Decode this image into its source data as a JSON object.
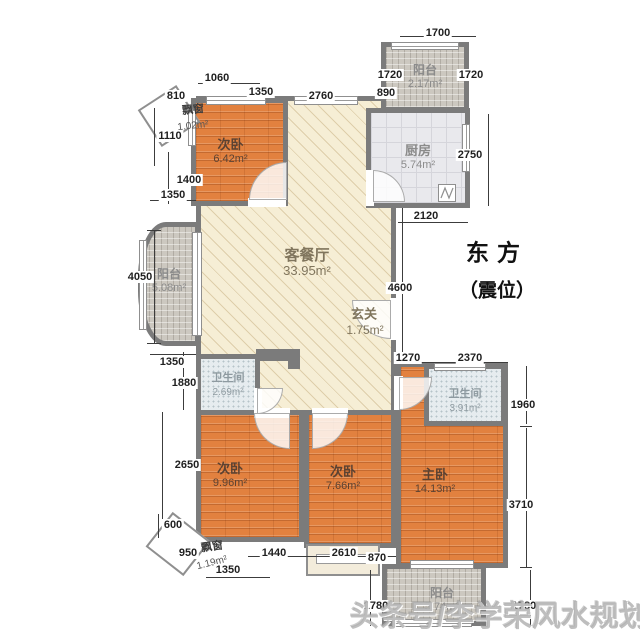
{
  "rooms": {
    "living": {
      "label": "客餐厅",
      "area": "33.95m²"
    },
    "entry": {
      "label": "玄关",
      "area": "1.75m²"
    },
    "bedroom_top": {
      "label": "次卧",
      "area": "6.42m²"
    },
    "kitchen": {
      "label": "厨房",
      "area": "5.74m²"
    },
    "balcony_top": {
      "label": "阳台",
      "area": "2.17m²"
    },
    "balcony_left": {
      "label": "阳台",
      "area": "5.08m²"
    },
    "bath_small": {
      "label": "卫生间",
      "area": "2.69m²"
    },
    "bedroom_left": {
      "label": "次卧",
      "area": "9.96m²"
    },
    "bedroom_mid": {
      "label": "次卧",
      "area": "7.66m²"
    },
    "master": {
      "label": "主卧",
      "area": "14.13m²"
    },
    "bath_master": {
      "label": "卫生间",
      "area": "3.91m²"
    },
    "balcony_bottom": {
      "label": "阳台",
      "area": "5.74m²"
    },
    "bay_top": {
      "label": "飘窗",
      "area": "1.02m²"
    },
    "bay_bottom": {
      "label": "飘窗",
      "area": "1.19m²"
    }
  },
  "dims": [
    "1700",
    "810",
    "1060",
    "1350",
    "2760",
    "890",
    "1720",
    "1720",
    "1110",
    "1400",
    "1350",
    "4050",
    "1350",
    "1880",
    "2650",
    "600",
    "950",
    "1350",
    "1440",
    "2610",
    "870",
    "2750",
    "2120",
    "4600",
    "1270",
    "2370",
    "1960",
    "3710",
    "1780",
    "1780"
  ],
  "compass": {
    "line1": "东方",
    "line2": "（震位）"
  },
  "watermark": "头条号/李学荣风水规划",
  "colors": {
    "wall": "#7b7b7b",
    "wood_floor": "#e2813f",
    "living_floor": "#f6eed5",
    "balcony": "#ccc8c0",
    "kitchen_tile": "#e9e9ed",
    "bath_tile": "#e6ecef"
  }
}
